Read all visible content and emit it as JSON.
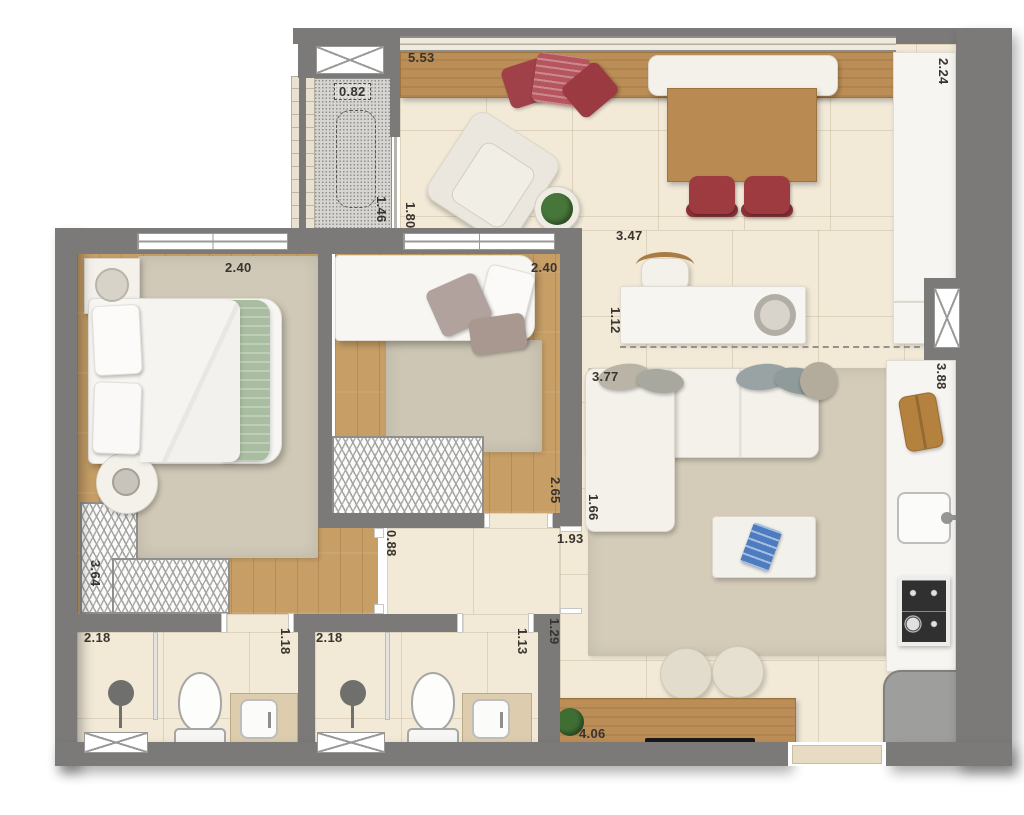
{
  "dims": [
    {
      "id": "balcony_width",
      "v": "5.53"
    },
    {
      "id": "shaft_width",
      "v": "0.82"
    },
    {
      "id": "laundry_width",
      "v": "1.46"
    },
    {
      "id": "balcony_depth",
      "v": "1.80"
    },
    {
      "id": "counter_top",
      "v": "2.24"
    },
    {
      "id": "dining_width",
      "v": "3.47"
    },
    {
      "id": "island_depth",
      "v": "1.12"
    },
    {
      "id": "bedroom1_width",
      "v": "2.40"
    },
    {
      "id": "bedroom2_width",
      "v": "2.40"
    },
    {
      "id": "living_width",
      "v": "3.77"
    },
    {
      "id": "kitchen_length",
      "v": "3.88"
    },
    {
      "id": "bedroom2_depth",
      "v": "2.65"
    },
    {
      "id": "wall_segment",
      "v": "1.66"
    },
    {
      "id": "hall_opening",
      "v": "1.93"
    },
    {
      "id": "hall_width",
      "v": "0.88"
    },
    {
      "id": "bedroom1_depth",
      "v": "3.64"
    },
    {
      "id": "bathroom1_width",
      "v": "2.18"
    },
    {
      "id": "bathroom1_depth",
      "v": "1.18"
    },
    {
      "id": "bathroom2_width",
      "v": "2.18"
    },
    {
      "id": "bathroom2_depth",
      "v": "1.13"
    },
    {
      "id": "passage_width",
      "v": "1.29"
    },
    {
      "id": "living_length",
      "v": "4.06"
    }
  ],
  "colors": {
    "wall": "#7b7a78",
    "tile_floor": "#f2e9d7",
    "wood_floor": "#c69e66",
    "accent_red": "#a64249",
    "accent_green": "#a9bea0",
    "counter_white": "#f7f5f1",
    "rug_beige": "#d4ccb9"
  },
  "icons": [
    "double-bed",
    "single-bed",
    "sofa",
    "coffee-table",
    "dining-table",
    "dining-chair",
    "armchair",
    "bench-cushion",
    "throw-pillow",
    "plant",
    "island-sink",
    "kitchen-sink",
    "cooktop",
    "fridge",
    "cutting-board",
    "toilet",
    "shower-head",
    "vanity-sink",
    "wardrobe",
    "nightstand",
    "table-lamp",
    "pouf",
    "sideboard",
    "tv",
    "window",
    "door"
  ]
}
